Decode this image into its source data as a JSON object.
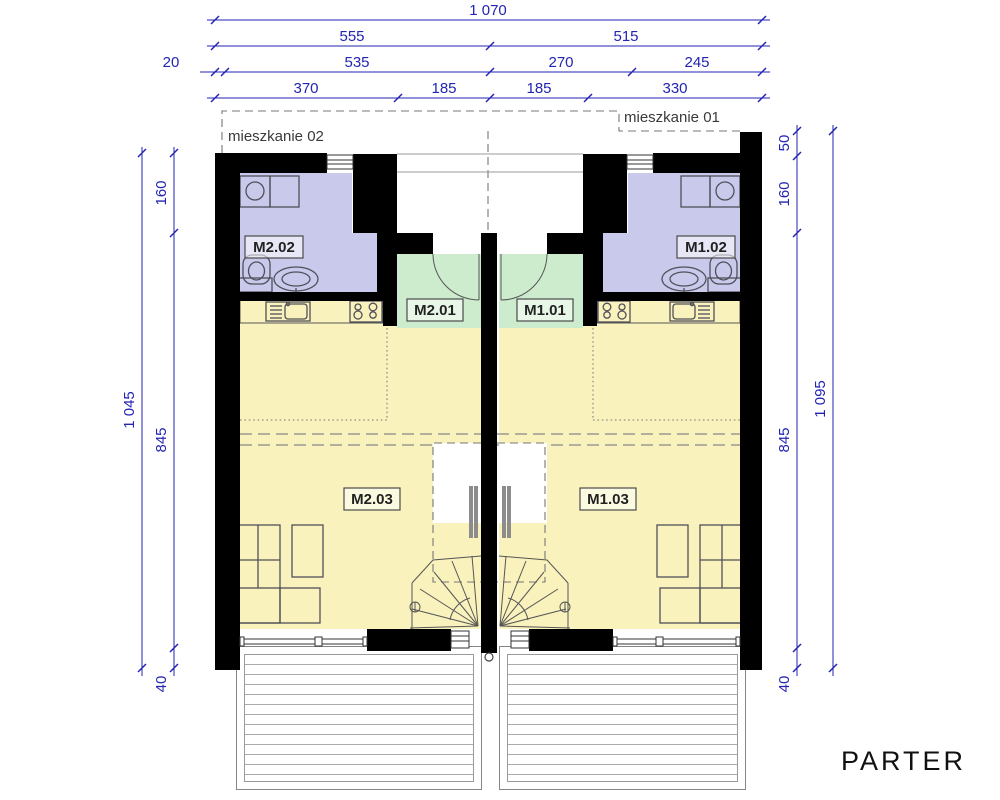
{
  "title": "PARTER",
  "units": {
    "unit02": {
      "name": "mieszkanie 02",
      "bath": "M2.02",
      "hall": "M2.01",
      "living": "M2.03"
    },
    "unit01": {
      "name": "mieszkanie 01",
      "bath": "M1.02",
      "hall": "M1.01",
      "living": "M1.03"
    }
  },
  "dimensions": {
    "top": {
      "total": "1 070",
      "row2": [
        "555",
        "515"
      ],
      "row3": [
        "20",
        "535",
        "270",
        "245"
      ],
      "row4": [
        "370",
        "185",
        "185",
        "330"
      ]
    },
    "left": {
      "total": "1 045",
      "segments": [
        "160",
        "845",
        "40"
      ]
    },
    "right": {
      "total": "1 095",
      "segments": [
        "50",
        "160",
        "845",
        "40"
      ]
    }
  },
  "colors": {
    "wall": "#000000",
    "bathroom": "#c9c9ec",
    "hall": "#cdeccd",
    "living": "#f9f2bd",
    "dimension": "#2323b4"
  }
}
